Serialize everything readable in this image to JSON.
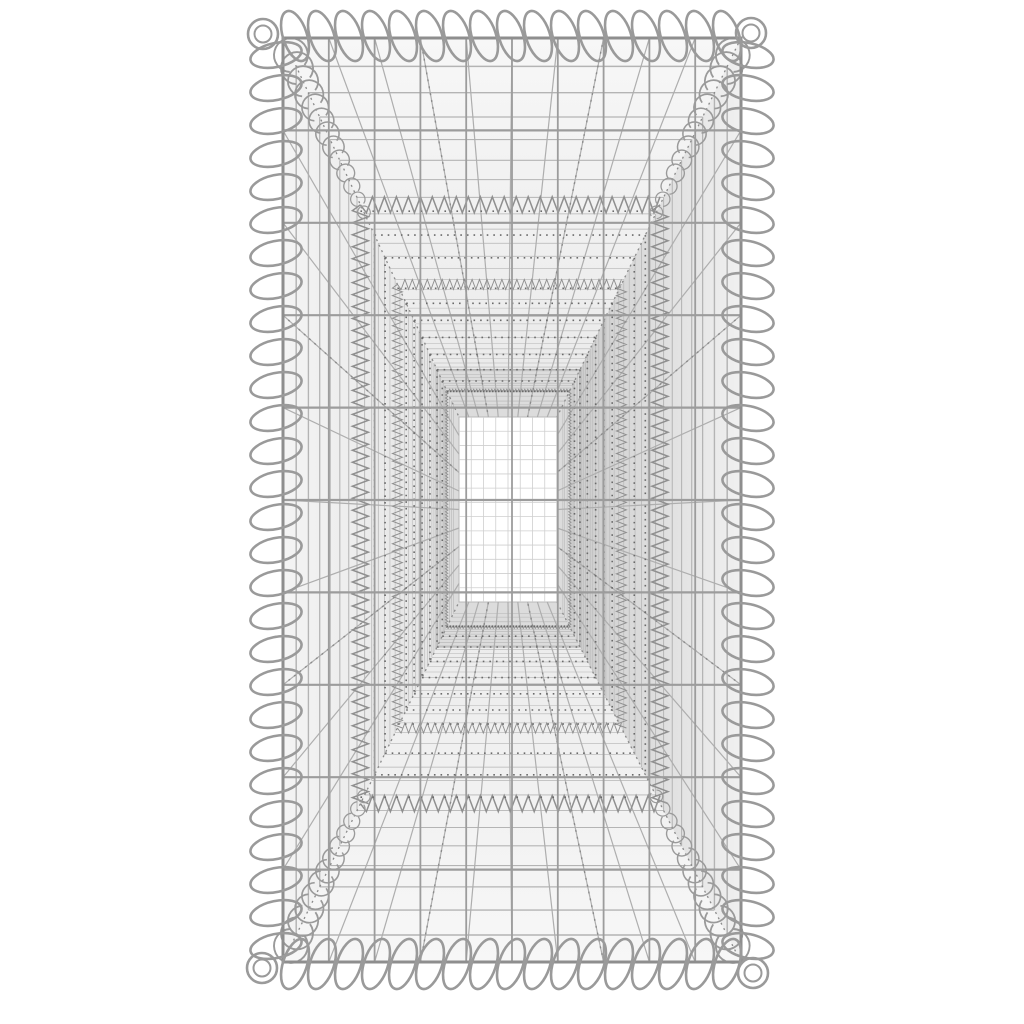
{
  "page": {
    "background": "#ffffff",
    "description": "Galvanised steel wire gabion basket photographed straight on, looking through the open front mesh down the hollow interior to the bright far-end mesh panel"
  },
  "scene": {
    "canvas": {
      "width": 1024,
      "height": 1024
    },
    "outer_rect": {
      "x0": 283,
      "y0": 38,
      "x1": 741,
      "y1": 962
    },
    "inner_rect": {
      "x0": 459,
      "y0": 417,
      "x1": 557,
      "y1": 602
    },
    "deep_rect_u": 0.875,
    "front_grid": {
      "cols": 10,
      "rows": 10
    },
    "longitudinal_wires_per_face": 9,
    "cross_wires": {
      "count": 34,
      "ratio": 0.925,
      "extra_u": [
        0.945,
        0.958,
        0.968
      ]
    },
    "seam_rings_u": [
      0.44,
      0.65,
      0.93
    ],
    "dot_rows_u": [
      0.52,
      0.58,
      0.7,
      0.745,
      0.79,
      0.835,
      0.875,
      0.905
    ],
    "radial_fractions": [
      0.3,
      0.7
    ],
    "edge_coils": {
      "top": {
        "count": 17,
        "pitch": 27,
        "start": 295,
        "c": 36,
        "rx": 12,
        "ry": 26,
        "tilt": -18
      },
      "bottom": {
        "count": 17,
        "pitch": 27,
        "start": 295,
        "c": 964,
        "rx": 12,
        "ry": 26,
        "tilt": 18
      },
      "left": {
        "count": 28,
        "pitch": 33,
        "start": 55,
        "c": 276,
        "rx": 26,
        "ry": 12,
        "tilt": -12
      },
      "right": {
        "count": 28,
        "pitch": 33,
        "start": 55,
        "c": 748,
        "rx": 26,
        "ry": 12,
        "tilt": 12
      }
    },
    "corner_loops": {
      "radius": 15,
      "inner_radius": 8.5,
      "centers": [
        [
          263,
          34
        ],
        [
          751,
          33
        ],
        [
          262,
          968
        ],
        [
          753,
          973
        ]
      ]
    },
    "corner_fans": {
      "arc_count": 13,
      "t_start": 0.045,
      "t_end": 0.46,
      "max_radius": 15,
      "gap_rad": 0.5
    },
    "colors": {
      "background": "#ffffff",
      "wire": "#9a9a9a",
      "wire_light": "#b4b4b4",
      "wire_mid": "#aeaeae",
      "wire_front": "#9c9c9c",
      "frame": "#8e8e8e",
      "dot": "#6a6a6a",
      "dotted_radial": "#8a8a8a",
      "zigzag": "#8f8f8f",
      "face_top": [
        "#f7f7f7",
        "#e9e9e9"
      ],
      "face_bottom": [
        "#f7f7f7",
        "#ebebeb"
      ],
      "face_left": [
        "#f4f4f4",
        "#e2e2e2"
      ],
      "face_right": [
        "#f0f0f0",
        "#c9c9c9"
      ],
      "deep_band": "#dcdcdc",
      "inner_fill": "#ffffff",
      "inner_grid": "#cfcfcf",
      "inner_outline": "#b8b8b8"
    }
  }
}
